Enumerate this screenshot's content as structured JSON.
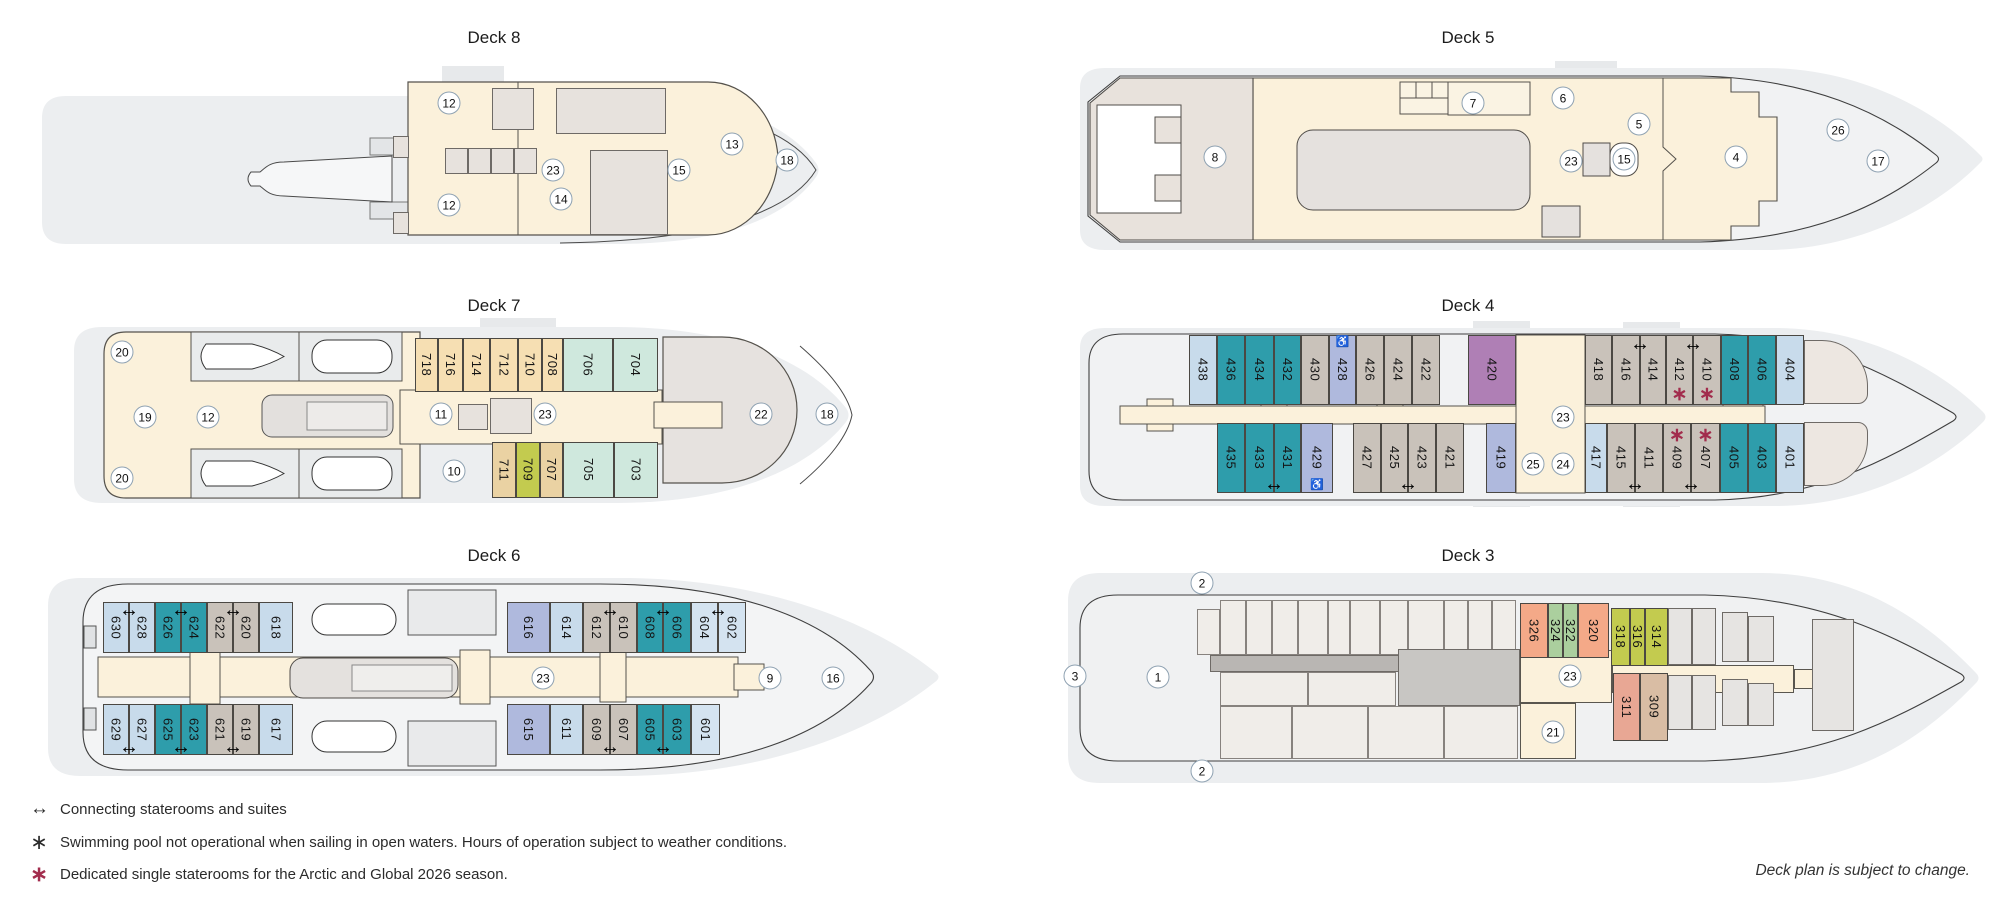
{
  "page": {
    "note": "Deck plan is subject to change."
  },
  "legend": {
    "connecting_label": "Connecting staterooms and suites",
    "pool_label": "Swimming pool not operational when sailing in open waters. Hours of operation subject to weather conditions.",
    "single_label": "Dedicated single staterooms for the Arctic and Global 2026 season."
  },
  "colors": {
    "teal": "#2E9DAB",
    "light_blue": "#C8DBEB",
    "light_blue_2": "#D4E3F0",
    "lavender": "#AFB9DD",
    "taupe": "#C9C2BA",
    "wheat": "#F6DFB3",
    "tan": "#EAD2A3",
    "mint": "#CFE8DD",
    "chartreuse": "#C3CB4F",
    "plum": "#AF7FB5",
    "salmon": "#F4A988",
    "green": "#ABCF9E",
    "rose": "#E8A794",
    "beige_tan": "#D9BDA4",
    "single_asterisk": "#A22D4D",
    "cream": "#FBF1DB",
    "hull": "#ECEEF0"
  },
  "decks": {
    "deck8": {
      "title": "Deck 8",
      "markers": [
        "12",
        "12",
        "23",
        "14",
        "15",
        "13",
        "18"
      ]
    },
    "deck7": {
      "title": "Deck 7",
      "cabins_top": [
        "718",
        "716",
        "714",
        "712",
        "710",
        "708",
        "706",
        "704"
      ],
      "cabins_bottom": [
        "711",
        "709",
        "707",
        "705",
        "703"
      ],
      "markers": [
        "20",
        "19",
        "12",
        "20",
        "11",
        "10",
        "23",
        "22",
        "18"
      ]
    },
    "deck6": {
      "title": "Deck 6",
      "cabins_top": [
        "630",
        "628",
        "626",
        "624",
        "622",
        "620",
        "618",
        "616",
        "614",
        "612",
        "610",
        "608",
        "606",
        "604",
        "602"
      ],
      "cabins_bottom": [
        "629",
        "627",
        "625",
        "623",
        "621",
        "619",
        "617",
        "615",
        "611",
        "609",
        "607",
        "605",
        "603",
        "601"
      ],
      "markers": [
        "23",
        "9",
        "16"
      ]
    },
    "deck5": {
      "title": "Deck 5",
      "markers": [
        "8",
        "7",
        "6",
        "5",
        "23",
        "15",
        "4",
        "26",
        "17"
      ]
    },
    "deck4": {
      "title": "Deck 4",
      "cabins_top": [
        "438",
        "436",
        "434",
        "432",
        "430",
        "428",
        "426",
        "424",
        "422",
        "420",
        "418",
        "416",
        "414",
        "412",
        "410",
        "408",
        "406",
        "404"
      ],
      "cabins_bottom": [
        "435",
        "433",
        "431",
        "429",
        "427",
        "425",
        "423",
        "421",
        "419",
        "417",
        "415",
        "411",
        "409",
        "407",
        "405",
        "403",
        "401"
      ],
      "markers": [
        "23",
        "25",
        "24"
      ]
    },
    "deck3": {
      "title": "Deck 3",
      "cabins_top": [
        "326",
        "324",
        "322",
        "320",
        "318",
        "316",
        "314"
      ],
      "cabins_bottom": [
        "311",
        "309"
      ],
      "markers": [
        "2",
        "3",
        "1",
        "23",
        "21",
        "2"
      ]
    }
  }
}
